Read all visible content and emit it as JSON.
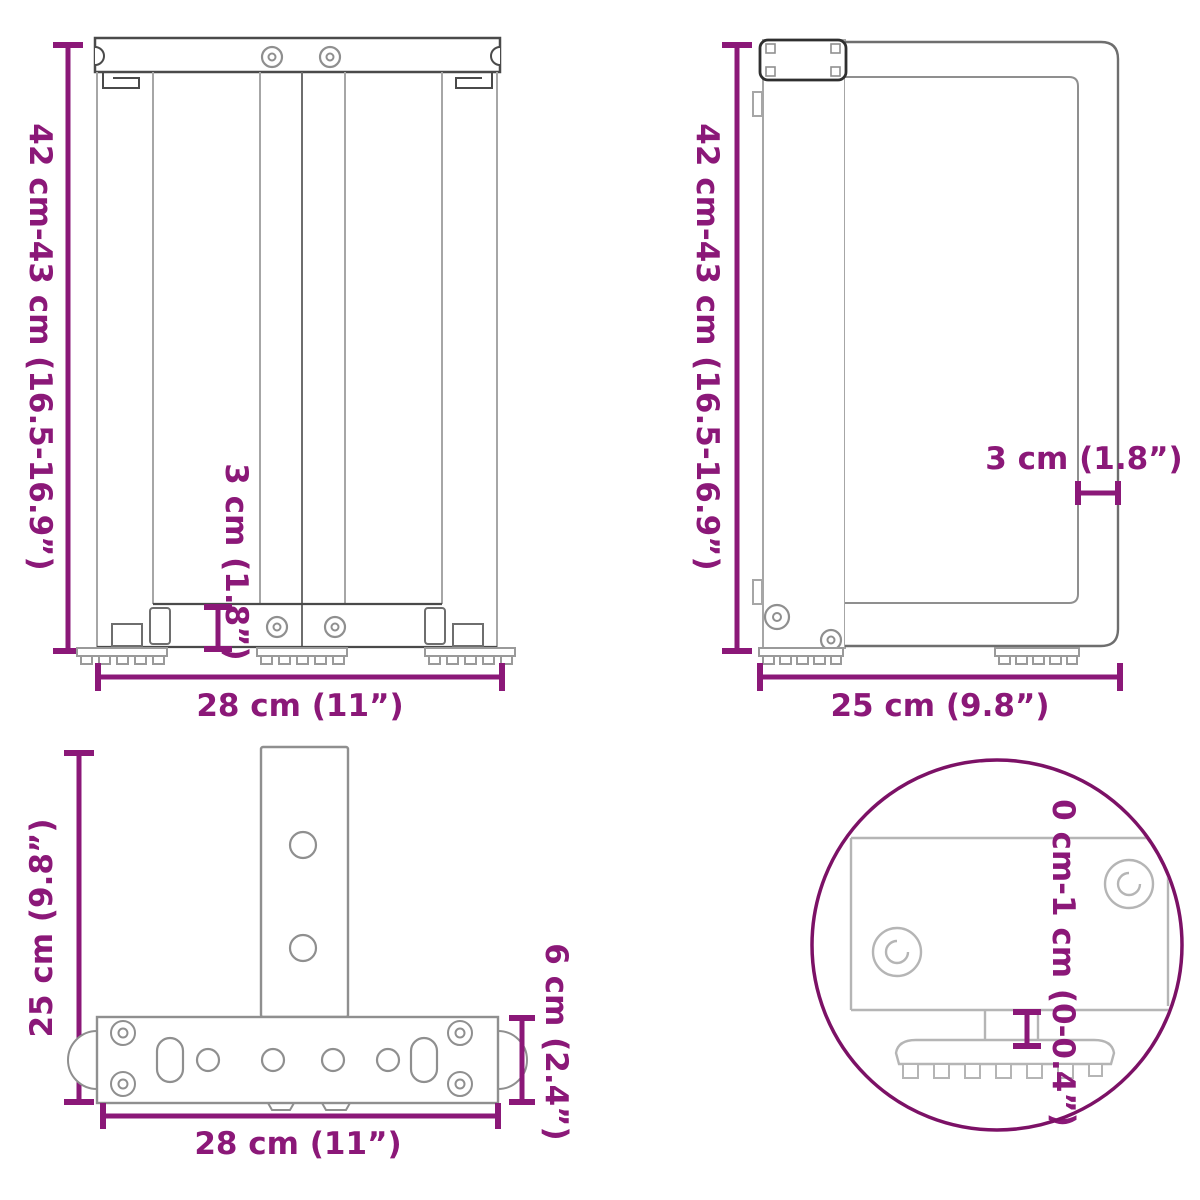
{
  "colors": {
    "dimension_accent": "#8b1878",
    "detail_circle": "#7c1166",
    "outline_dark": "#4a4a4a",
    "outline_mid": "#8f8f8f",
    "outline_light": "#b5b5b5",
    "background": "#ffffff"
  },
  "views": {
    "front": {
      "height_label": "42 cm-43 cm (16.5-16.9”)",
      "inset_label": "3 cm (1.8”)",
      "width_label": "28 cm (11”)"
    },
    "side": {
      "height_label": "42 cm-43 cm (16.5-16.9”)",
      "offset_label": "3 cm (1.8”)",
      "depth_label": "25 cm (9.8”)"
    },
    "top": {
      "depth_label": "25 cm (9.8”)",
      "bar_label": "6 cm (2.4”)",
      "width_label": "28 cm (11”)"
    },
    "detail": {
      "range_label": "0 cm-1 cm (0-0.4”)"
    }
  }
}
